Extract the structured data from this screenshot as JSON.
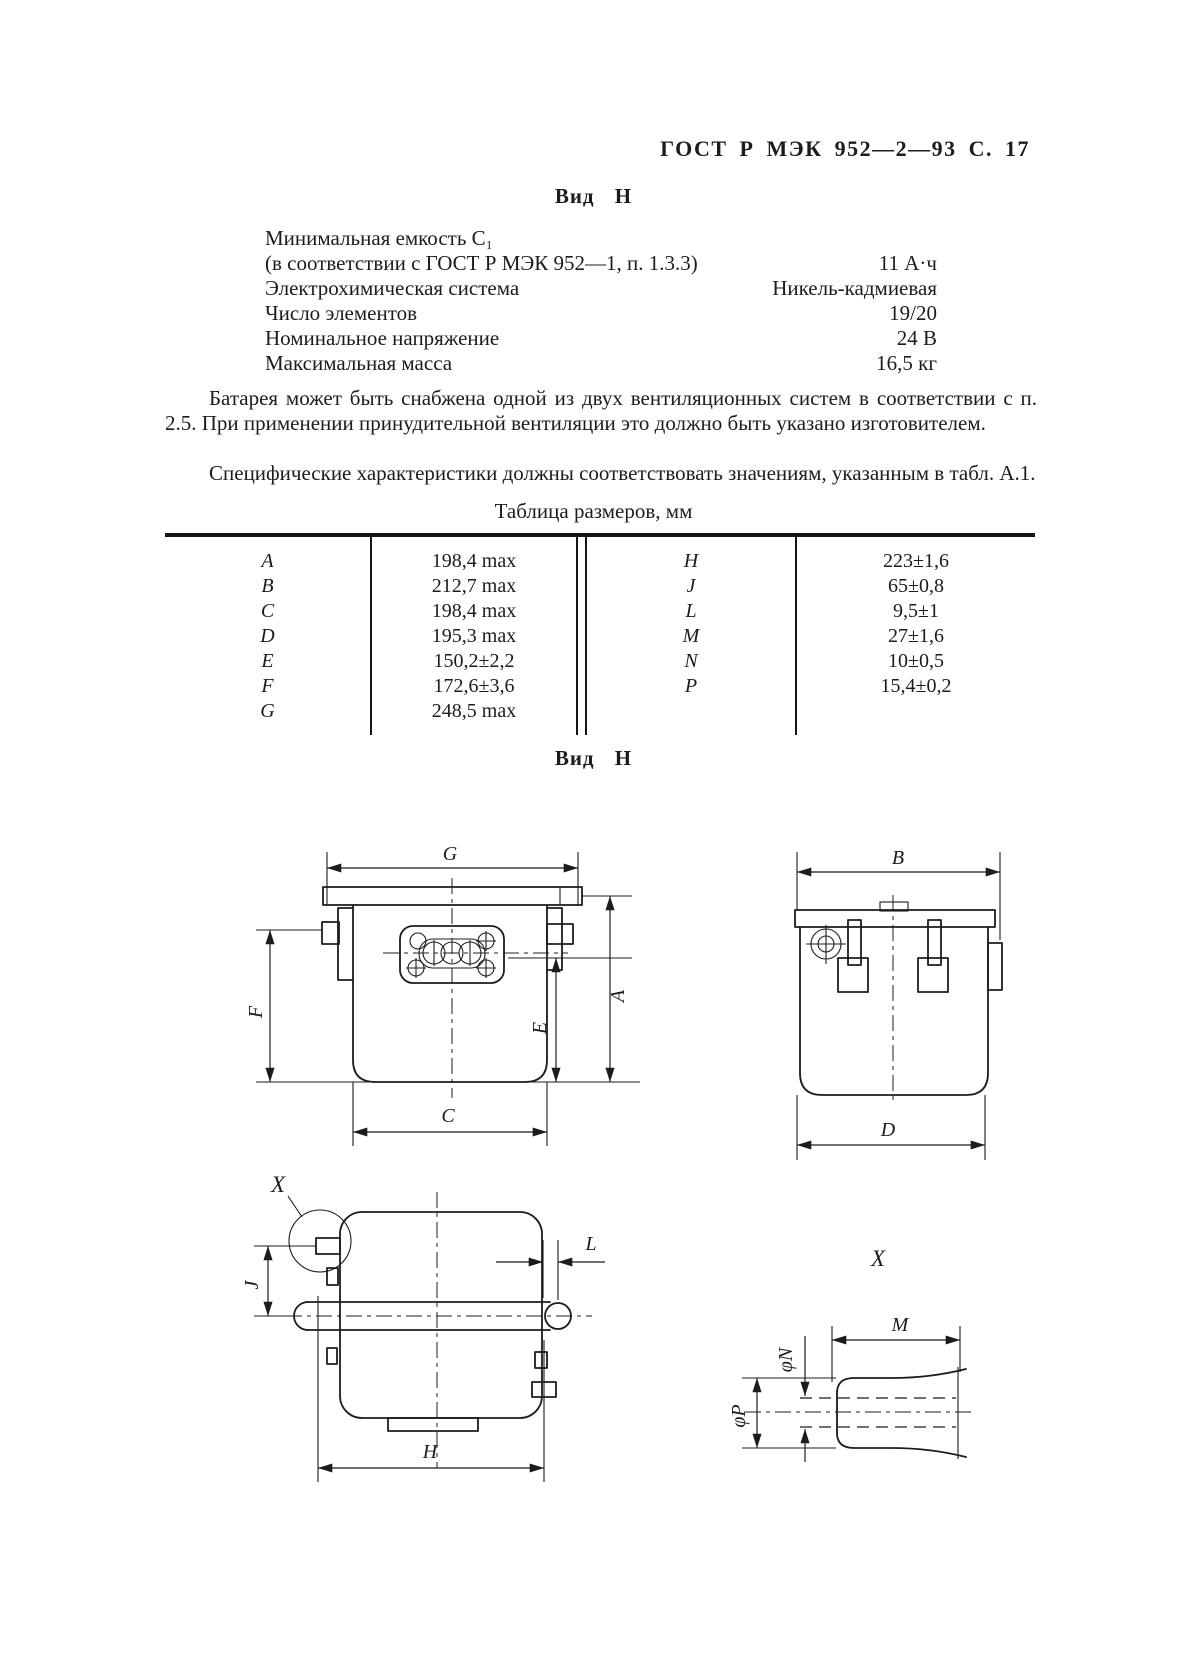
{
  "header": {
    "title": "ГОСТ Р МЭК 952—2—93 С. 17"
  },
  "headings": {
    "view_top": "Вид Н",
    "view_bottom": "Вид Н"
  },
  "specs": [
    {
      "label": "Минимальная емкость С₁",
      "value": ""
    },
    {
      "label": "(в соответствии с ГОСТ Р МЭК 952—1, п. 1.3.3)",
      "value": "11 А·ч"
    },
    {
      "label": "Электрохимическая система",
      "value": "Никель-кадмиевая"
    },
    {
      "label": "Число элементов",
      "value": "19/20"
    },
    {
      "label": "Номинальное напряжение",
      "value": "24 В"
    },
    {
      "label": "Максимальная масса",
      "value": "16,5 кг"
    }
  ],
  "paragraphs": [
    "Батарея может быть снабжена одной из двух вентиляционных систем в соответствии с п. 2.5. При применении принудительной вентиляции это должно быть указано изготовителем.",
    "Специфические характеристики должны соответствовать значениям, указанным в табл. А.1."
  ],
  "size_table": {
    "title": "Таблица размеров, мм",
    "left": [
      [
        "A",
        "198,4 max"
      ],
      [
        "B",
        "212,7 max"
      ],
      [
        "C",
        "198,4 max"
      ],
      [
        "D",
        "195,3 max"
      ],
      [
        "E",
        "150,2±2,2"
      ],
      [
        "F",
        "172,6±3,6"
      ],
      [
        "G",
        "248,5 max"
      ]
    ],
    "right": [
      [
        "H",
        "223±1,6"
      ],
      [
        "J",
        "65±0,8"
      ],
      [
        "L",
        "9,5±1"
      ],
      [
        "M",
        "27±1,6"
      ],
      [
        "N",
        "10±0,5"
      ],
      [
        "P",
        "15,4±0,2"
      ]
    ]
  },
  "drawing_labels": {
    "g": "G",
    "f": "F",
    "e": "E",
    "a": "A",
    "c": "C",
    "b": "B",
    "d": "D",
    "x_callout": "X",
    "j": "J",
    "l": "L",
    "h": "H",
    "x_detail": "X",
    "m": "M",
    "phi_n": "φN",
    "phi_p": "φP"
  }
}
